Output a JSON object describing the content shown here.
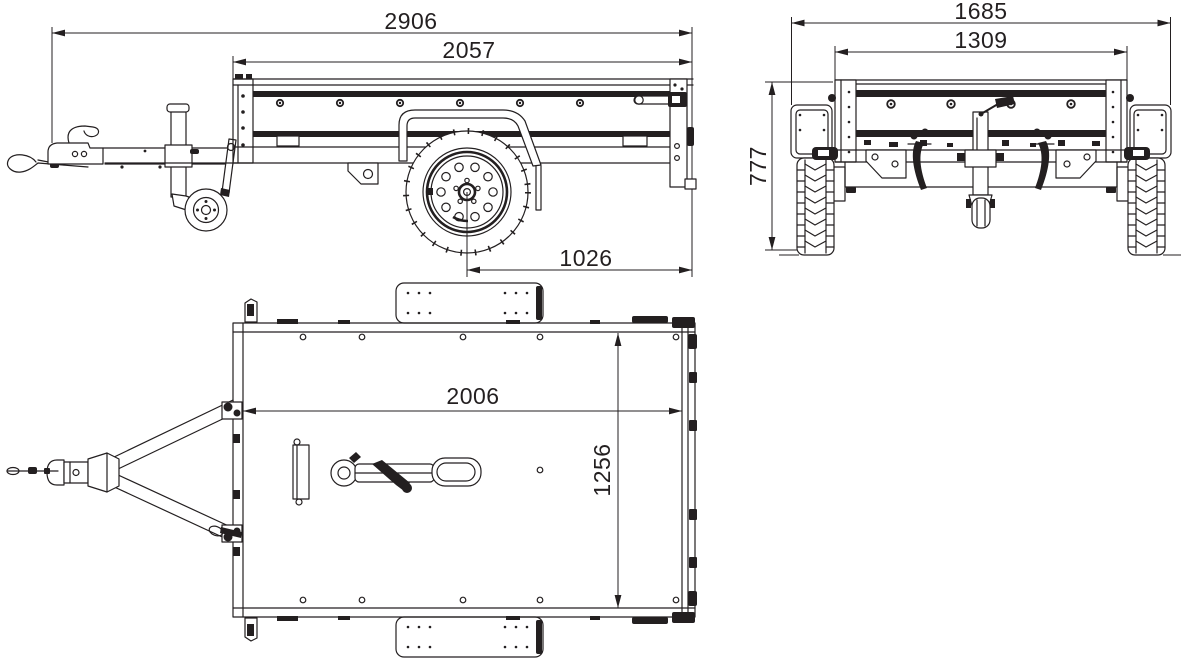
{
  "drawing": {
    "type": "trailer-three-view-technical-drawing",
    "background_color": "#ffffff",
    "line_color": "#231f20",
    "views": {
      "side_view": {
        "label": "side view",
        "dimensions": {
          "overall_length": "2906",
          "box_length": "2057",
          "axle_to_rear": "1026"
        }
      },
      "rear_view": {
        "label": "rear view",
        "dimensions": {
          "overall_width": "1685",
          "box_width": "1309",
          "overall_height": "777"
        }
      },
      "top_view": {
        "label": "top view",
        "dimensions": {
          "inner_length": "2006",
          "inner_width": "1256"
        }
      }
    }
  }
}
